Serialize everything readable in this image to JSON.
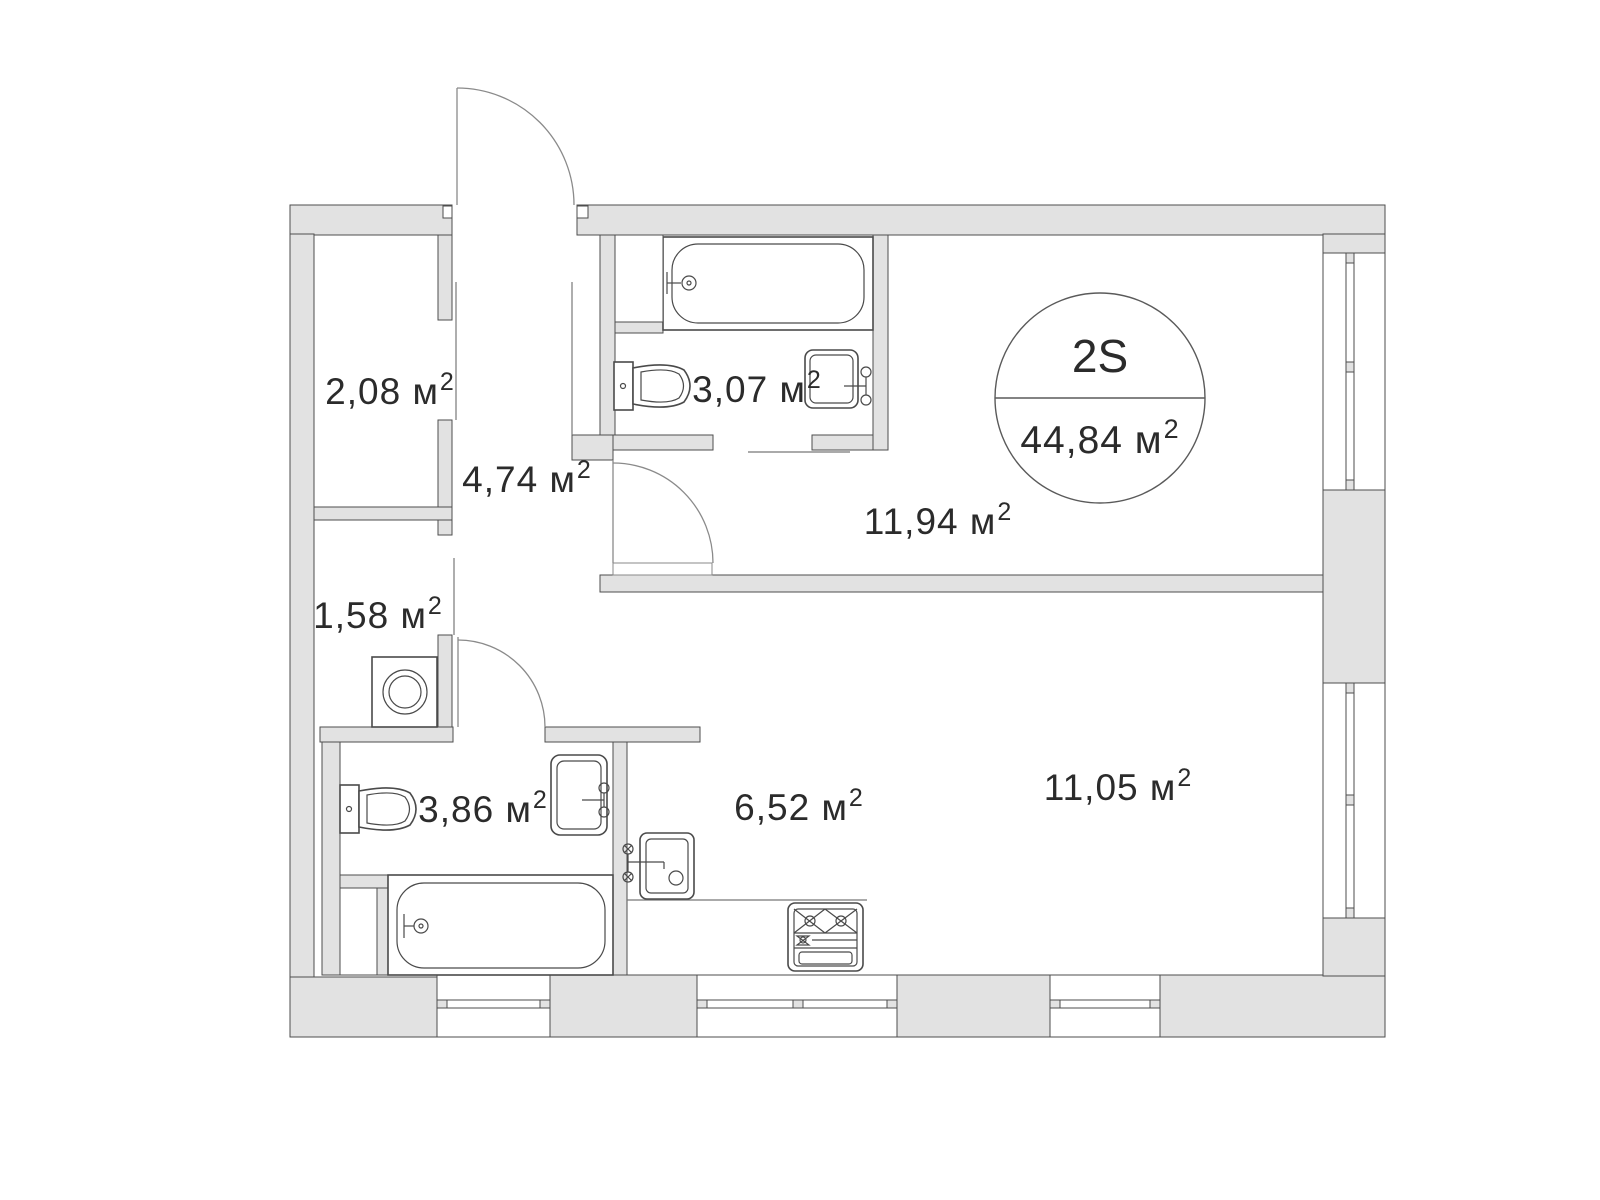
{
  "plan": {
    "type": "apartment-floor-plan",
    "badge": {
      "type_label": "2S",
      "area_value": "44,84 м",
      "area_sup": "2"
    },
    "rooms": [
      {
        "id": "storage",
        "area_value": "2,08 м",
        "area_sup": "2"
      },
      {
        "id": "hallway",
        "area_value": "4,74 м",
        "area_sup": "2"
      },
      {
        "id": "bathroom-top",
        "area_value": "3,07 м",
        "area_sup": "2"
      },
      {
        "id": "bedroom",
        "area_value": "11,94 м",
        "area_sup": "2"
      },
      {
        "id": "laundry",
        "area_value": "1,58 м",
        "area_sup": "2"
      },
      {
        "id": "bathroom-bottom",
        "area_value": "3,86 м",
        "area_sup": "2"
      },
      {
        "id": "kitchen",
        "area_value": "6,52 м",
        "area_sup": "2"
      },
      {
        "id": "living-room",
        "area_value": "11,05 м",
        "area_sup": "2"
      }
    ],
    "colors": {
      "wall_fill": "#e2e2e2",
      "outline": "#4e4e4e",
      "thin_line": "#787878",
      "text": "#2b2b2b",
      "background": "#ffffff"
    }
  }
}
